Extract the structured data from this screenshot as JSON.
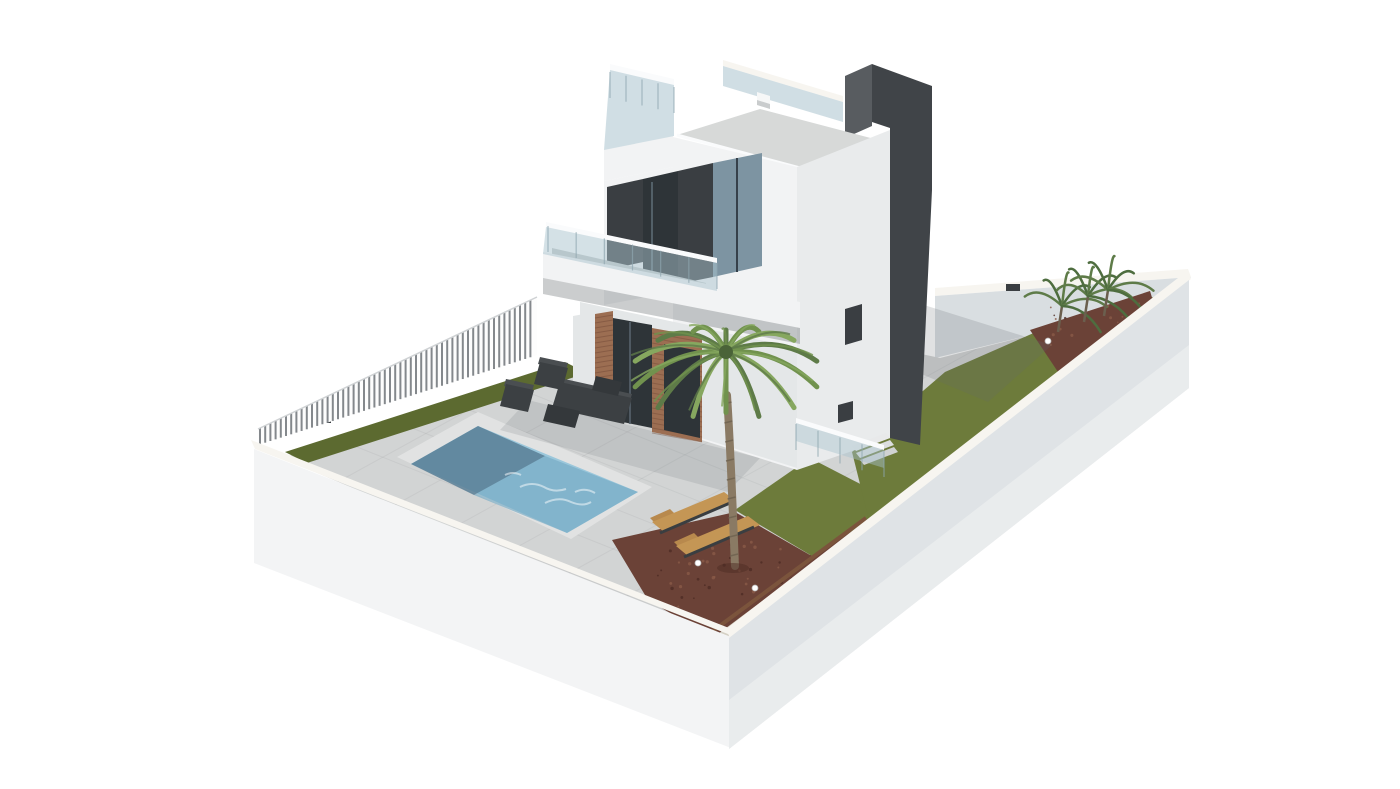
{
  "scene": {
    "type": "3d-architectural-render",
    "description": "3D architectural render of a modern white two-storey villa with rooftop terrace, glass balustrades, dark stair tower, private swimming pool, sun loungers, lounge furniture, palm tree, lawns, mulch beds and white perimeter walls on an isometric plot",
    "parts": [
      {
        "id": "villa",
        "label": "modern villa"
      },
      {
        "id": "roof-terrace",
        "label": "rooftop terrace with glass railing"
      },
      {
        "id": "stair-tower",
        "label": "dark stair tower"
      },
      {
        "id": "balcony",
        "label": "first floor balcony with glass balustrade"
      },
      {
        "id": "swimming-pool",
        "label": "swimming pool"
      },
      {
        "id": "sun-loungers",
        "label": "two wooden sun loungers"
      },
      {
        "id": "lounge-set",
        "label": "dark outdoor lounge furniture"
      },
      {
        "id": "palm-tree",
        "label": "palm tree"
      },
      {
        "id": "tropical-plants",
        "label": "tropical plants in corner bed"
      },
      {
        "id": "lawn",
        "label": "lawn areas"
      },
      {
        "id": "mulch-bed",
        "label": "red-brown mulch beds"
      },
      {
        "id": "perimeter-wall",
        "label": "white perimeter walls"
      },
      {
        "id": "slat-fence",
        "label": "vertical slat fence"
      }
    ]
  },
  "palette": {
    "background": "#ffffff",
    "wallFaceLight": "#f3f4f5",
    "wallFaceShade": "#dfe3e6",
    "wallCap": "#f7f5f0",
    "wallInner": "#d9dee1",
    "paving": "#d2d4d4",
    "grass": "#6d7b3b",
    "grassDark": "#5c6a30",
    "pool1": "#9bc7db",
    "pool2": "#74abc4",
    "poolShadow": "#587e95",
    "poolCoping": "#e1e2e2",
    "mulch": "#6b4237",
    "gravel": "#d5d1c5",
    "edging": "#7b543c",
    "brick": "#9c6e52",
    "houseWhite": "#f2f3f4",
    "houseShade": "#e4e7e8",
    "facadeRight": "#e9ebec",
    "darkPanel": "#3a3e42",
    "glassDark": "#2e3438",
    "glassBlue": "#7d94a2",
    "glassRail": "#a9c3ce",
    "towerDark": "#404448",
    "towerSide": "#585c60",
    "roofSlab": "#d7d9d8",
    "furniture": "#3c4043",
    "furnitureLight": "#4a4e51",
    "tableDark": "#34383b",
    "lounger": "#c49655",
    "loungerShade": "#b8894d",
    "palmTrunk": "#8a7a64",
    "palm1": "#5e7b48",
    "palm2": "#71924e",
    "palm3": "#86a75f",
    "plant": "#4e6d3f"
  }
}
